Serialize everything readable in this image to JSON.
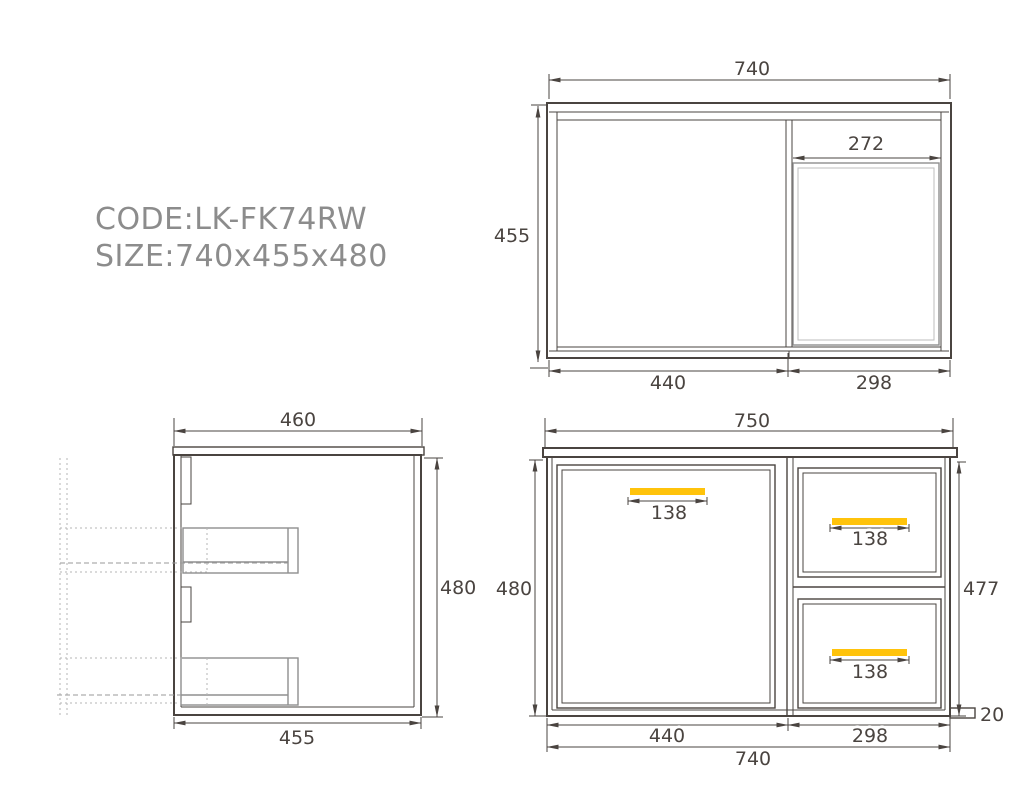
{
  "label_block": {
    "code": "CODE:LK-FK74RW",
    "size": "SIZE:740x455x480"
  },
  "top_view": {
    "view": "plan view of cabinet with basin",
    "dims": {
      "overall_width": "740",
      "overall_depth": "455",
      "basin_width": "272",
      "door_section_width": "440",
      "drawer_section_width": "298"
    }
  },
  "side_view": {
    "view": "side section view with drawer guides",
    "dims": {
      "top_depth": "460",
      "height": "480",
      "bottom_depth": "455"
    }
  },
  "front_view": {
    "view": "front elevation with door and two drawers",
    "dims": {
      "countertop_width": "750",
      "left_height": "480",
      "right_height": "477",
      "door_handle_width": "138",
      "top_drawer_handle_width": "138",
      "bottom_drawer_handle_width": "138",
      "door_section_width": "440",
      "drawer_section_width": "298",
      "cabinet_width": "740",
      "side_panel_depth": "20"
    }
  },
  "colors": {
    "line": "#4a4440",
    "handle_accent": "#ffc30b",
    "secondary_line": "#8f8f8f",
    "light_line": "#bdbdbd",
    "dashed_guide": "#b5b5b5",
    "label_text": "#8c8c8c"
  }
}
